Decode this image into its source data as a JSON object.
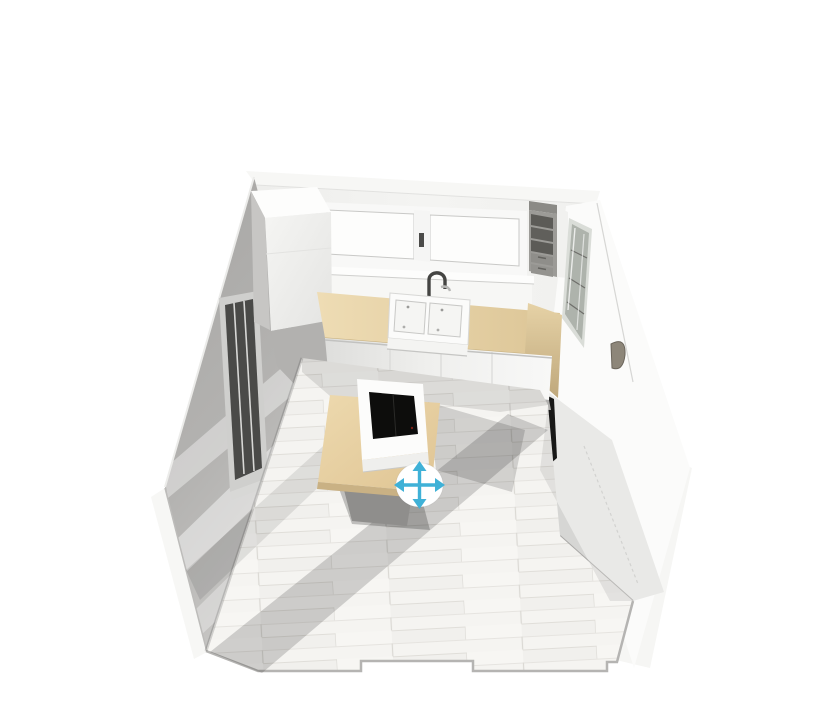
{
  "viewport": {
    "name": "3D kitchen planner view",
    "background": "#ffffff"
  },
  "move_tool": {
    "icon": "move-arrows-icon",
    "accent_color": "#3fb1d7",
    "bubble_color": "#ffffff"
  },
  "palette": {
    "wall_lit": "#f2f2f0",
    "wall_shadow_dark": "#a7a6a4",
    "wall_shadow_light": "#c6c5c3",
    "cap_white": "#f6f6f4",
    "cabinet_white": "#fbfbfa",
    "cabinet_gray": "#e9e9e7",
    "countertop_wood": "#eedcb4",
    "countertop_wood_shade": "#dcc596",
    "island_wood": "#edd9ae",
    "island_wood_shade": "#dfc493",
    "floor_base": "#f5f4f1",
    "floor_line": "#e0ded9",
    "sink_white": "#fbfbfa",
    "hob_black": "#0d0d0c",
    "glass_door_dark": "#4a4a48",
    "shelf_unit_gray": "#9c9b97",
    "shelf_cubby_dark": "#5c5b57"
  },
  "scene_objects": [
    {
      "id": "window-two-sash",
      "label": "double casement window"
    },
    {
      "id": "corner-tall-cabinet",
      "label": "tall corner cabinet"
    },
    {
      "id": "open-shelf-unit",
      "label": "wall shelf unit with drawers"
    },
    {
      "id": "glass-display-cabinet",
      "label": "glass display cabinet"
    },
    {
      "id": "countertop",
      "label": "wood countertop"
    },
    {
      "id": "farmhouse-sink",
      "label": "double farmhouse sink"
    },
    {
      "id": "faucet",
      "label": "mixer tap"
    },
    {
      "id": "base-cabinets",
      "label": "white base cabinets"
    },
    {
      "id": "tall-cabinets-right",
      "label": "tall cabinet run with oven"
    },
    {
      "id": "kitchen-island",
      "label": "island with induction hob"
    },
    {
      "id": "glazed-door",
      "label": "glazed door on left wall"
    },
    {
      "id": "wood-floor",
      "label": "whitewashed plank floor"
    },
    {
      "id": "move-handle",
      "label": "move selection handle"
    }
  ]
}
